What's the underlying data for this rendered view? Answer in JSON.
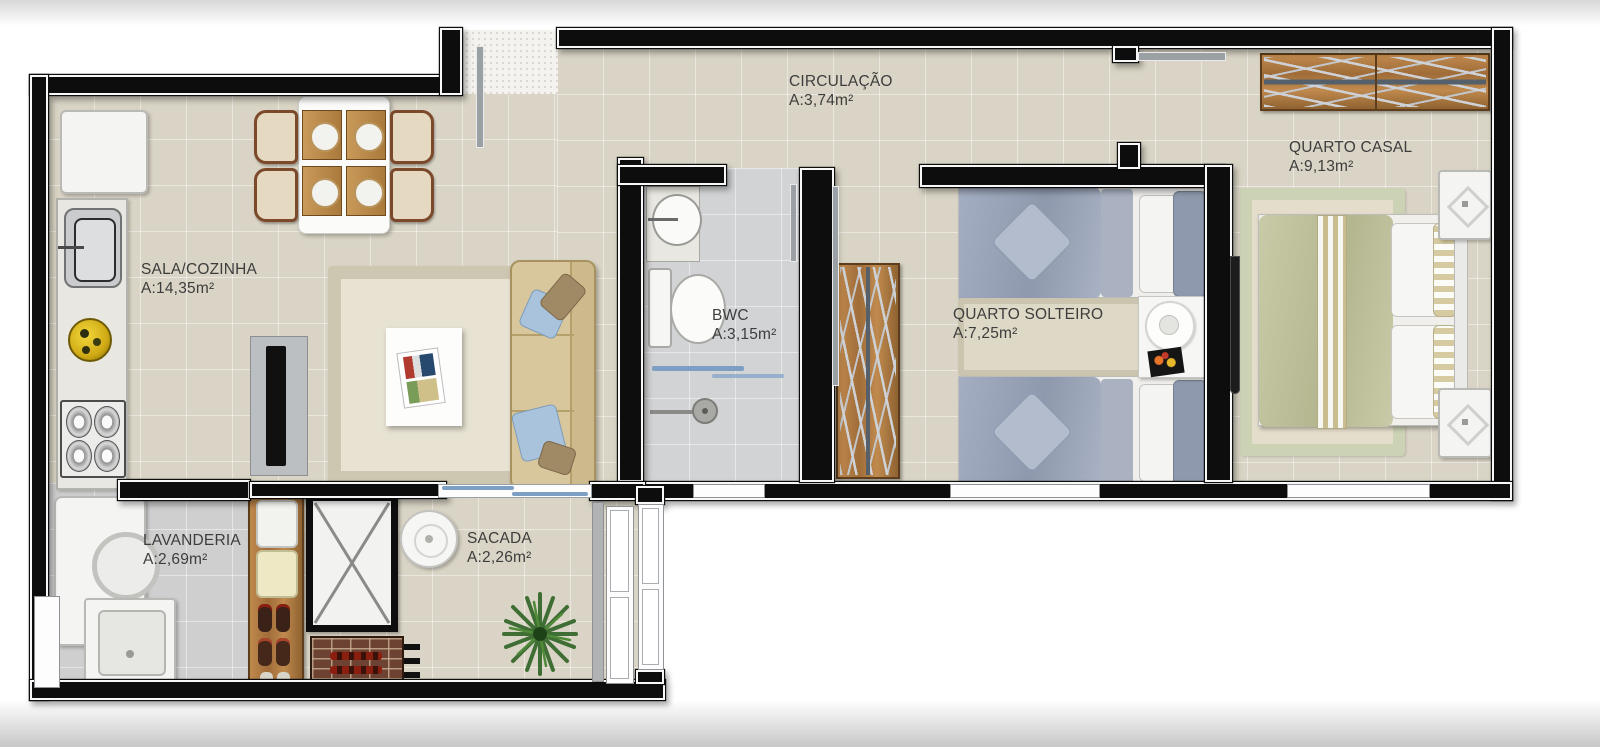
{
  "rooms": [
    {
      "id": "sala-cozinha",
      "label": "SALA/COZINHA",
      "area": "A:14,35m²"
    },
    {
      "id": "circulacao",
      "label": "CIRCULAÇÃO",
      "area": "A:3,74m²"
    },
    {
      "id": "bwc",
      "label": "BWC",
      "area": "A:3,15m²"
    },
    {
      "id": "quarto-solteiro",
      "label": "QUARTO SOLTEIRO",
      "area": "A:7,25m²"
    },
    {
      "id": "quarto-casal",
      "label": "QUARTO CASAL",
      "area": "A:9,13m²"
    },
    {
      "id": "lavanderia",
      "label": "LAVANDERIA",
      "area": "A:2,69m²"
    },
    {
      "id": "sacada",
      "label": "SACADA",
      "area": "A:2,26m²"
    }
  ],
  "furniture_icons": [
    "fridge-icon",
    "kitchen-sink-icon",
    "fruit-bowl-icon",
    "stove-icon",
    "dining-table-icon",
    "chair-icon",
    "placemat-icon",
    "tv-icon",
    "rug-icon",
    "coffee-table-icon",
    "magazine-icon",
    "sofa-icon",
    "vanity-sink-icon",
    "toilet-icon",
    "shower-drain-icon",
    "towel-bar-icon",
    "wardrobe-icon",
    "single-bed-icon",
    "double-bed-icon",
    "nightstand-icon",
    "lamp-icon",
    "washing-machine-icon",
    "laundry-tank-icon",
    "shoe-shelf-icon",
    "duct-shaft-icon",
    "barbecue-grill-icon",
    "round-table-icon",
    "plant-icon",
    "window-icon",
    "door-icon"
  ],
  "colors": {
    "wall": "#0d0d0d",
    "floor_beige": "#d9d4c5",
    "floor_gray": "#d2d3d5",
    "floor_laundry": "#cfcfcf",
    "wood": "#b9834c",
    "bed_gray": "#9aa4b8",
    "bed_green": "#c3c5a2",
    "rug_green": "#ccd3b4",
    "sofa_tan": "#d8c79c",
    "accent_blue": "#9db8d2",
    "window_blue": "#7e9fc4",
    "label_text": "#3d3d3d"
  }
}
